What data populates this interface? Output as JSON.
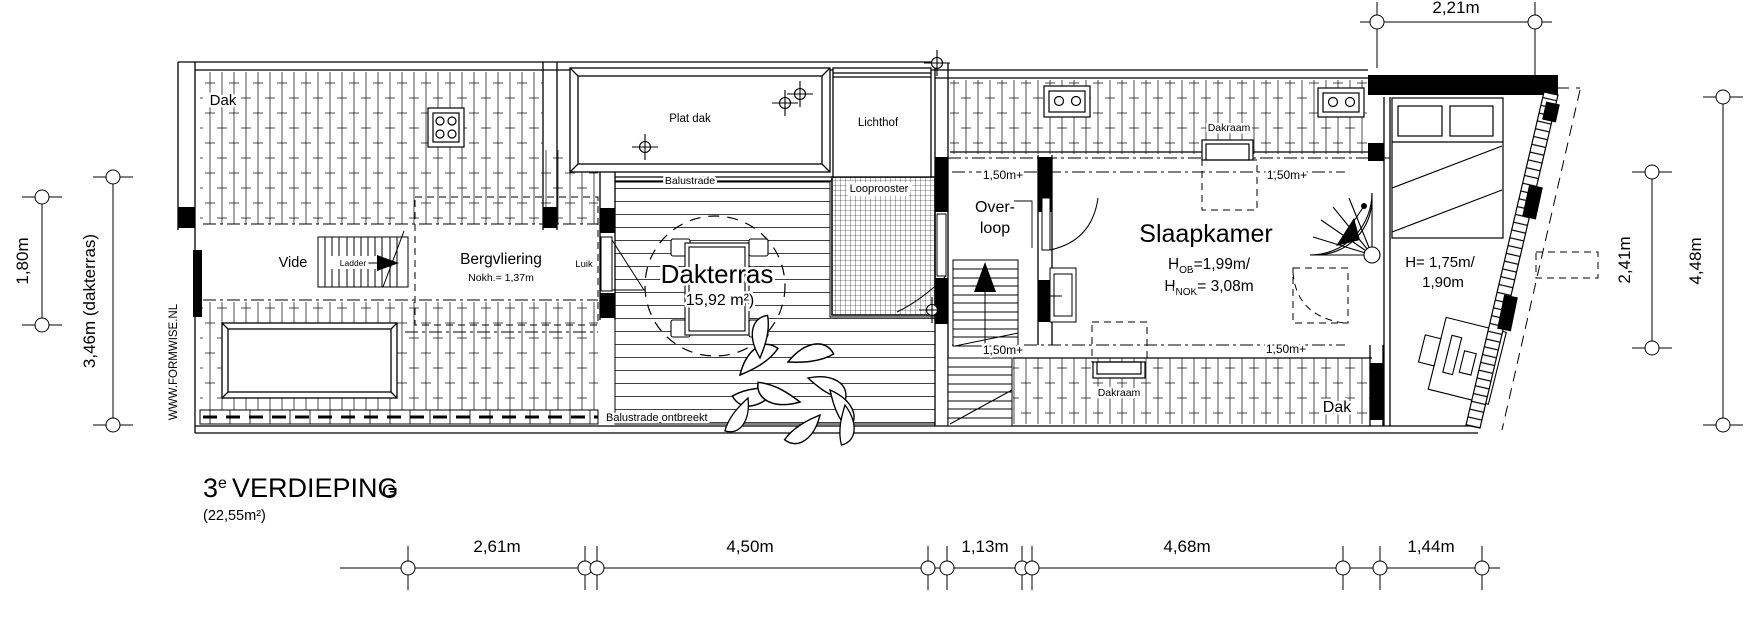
{
  "title": {
    "floor_number": "3",
    "floor_superscript": "e",
    "floor_name": "VERDIEPING",
    "floor_area": "(22,55m²)"
  },
  "watermark": "WWW.FORMWISE.NL",
  "grid_axis_label": "G",
  "rooms": {
    "dak_top_left": "Dak",
    "plat_dak_top": "Plat dak",
    "plat_dak_bottom_left": "Plat dak",
    "lichthof": "Lichthof",
    "looprooster": "Looprooster",
    "balustrade": "Balustrade",
    "balustrade_missing": "Balustrade ontbreekt",
    "vide": "Vide",
    "ladder": "Ladder",
    "bergvliering": "Bergvliering",
    "bergvliering_ridge_height": "Nokh.= 1,37m",
    "luik": "Luik",
    "dakterras": "Dakterras",
    "dakterras_area": "15,92 m²)",
    "overloop_line1": "Over-",
    "overloop_line2": "loop",
    "slaapkamer": "Slaapkamer",
    "dakraam_top": "Dakraam",
    "dakraam_bottom": "Dakraam",
    "dak_bottom_right": "Dak"
  },
  "levels": {
    "top_left": "1,50m+",
    "top_right": "1,50m+",
    "bottom_left": "1,50m+",
    "bottom_right": "1,50m+"
  },
  "heights": {
    "slaapkamer_h": "H",
    "slaapkamer_sub1": "OB",
    "slaapkamer_val1": "=1,99m/",
    "slaapkamer_sub2": "NOK",
    "slaapkamer_val2": "= 3,08m",
    "bed_line1": "H= 1,75m/",
    "bed_line2": "1,90m"
  },
  "dimensions": {
    "top": "2,21m",
    "left_inner": "1,80m",
    "left_outer": "3,46m (dakterras)",
    "right_inner": "2,41m",
    "right_outer": "4,48m",
    "bottom": [
      "2,61m",
      "4,50m",
      "1,13m",
      "4,68m",
      "1,44m"
    ]
  },
  "colors": {
    "line": "#000000",
    "background": "#ffffff"
  }
}
